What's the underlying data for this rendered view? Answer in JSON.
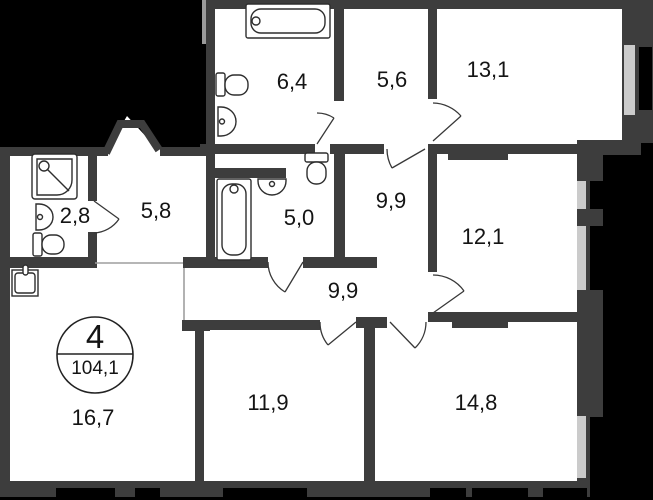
{
  "floorplan": {
    "unit_circle": {
      "rooms_count": "4",
      "total_area": "104,1"
    },
    "rooms": [
      {
        "name": "bathroom-top",
        "area": "6,4"
      },
      {
        "name": "entry-hall",
        "area": "5,6"
      },
      {
        "name": "bedroom-top-right",
        "area": "13,1"
      },
      {
        "name": "wc-shower",
        "area": "2,8"
      },
      {
        "name": "hallway",
        "area": "5,8"
      },
      {
        "name": "bathroom-second",
        "area": "5,0"
      },
      {
        "name": "corridor-upper",
        "area": "9,9"
      },
      {
        "name": "bedroom-right",
        "area": "12,1"
      },
      {
        "name": "corridor-lower",
        "area": "9,9"
      },
      {
        "name": "kitchen-living",
        "area": "16,7"
      },
      {
        "name": "bedroom-bottom-middle",
        "area": "11,9"
      },
      {
        "name": "bedroom-bottom-right",
        "area": "14,8"
      }
    ],
    "colors": {
      "wall": "#3d3d3d",
      "outside": "#000000",
      "window_glass": "#cbcbcb",
      "floor": "#ffffff",
      "fixture_line": "#2e2e2e"
    }
  }
}
